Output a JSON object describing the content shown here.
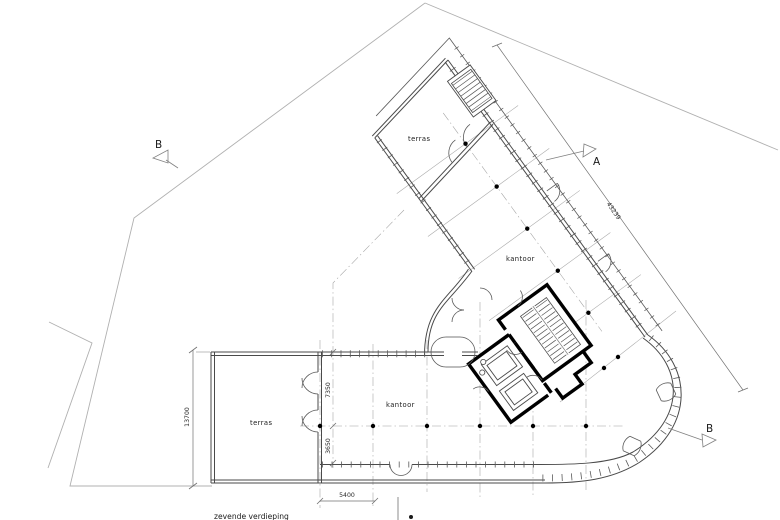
{
  "drawing": {
    "floor_title": "zevende verdieping",
    "labels": {
      "terras_wing": "terras",
      "kantoor_wing": "kantoor",
      "terras_lower": "terras",
      "kantoor_lower": "kantoor"
    },
    "section_markers": {
      "a": "A",
      "b_left": "B",
      "b_right": "B"
    },
    "dimensions": {
      "facade_length": "43239",
      "lower_wing_depth": "13700",
      "bay_depth_upper": "7350",
      "bay_depth_lower": "3650",
      "bay_width": "5400"
    },
    "colors": {
      "background": "#ffffff",
      "wall": "#4a4a4a",
      "wall_bold": "#000000",
      "grid": "#a0a0a0",
      "site_boundary": "#b0b0b0",
      "text": "#1a1a1a"
    }
  }
}
